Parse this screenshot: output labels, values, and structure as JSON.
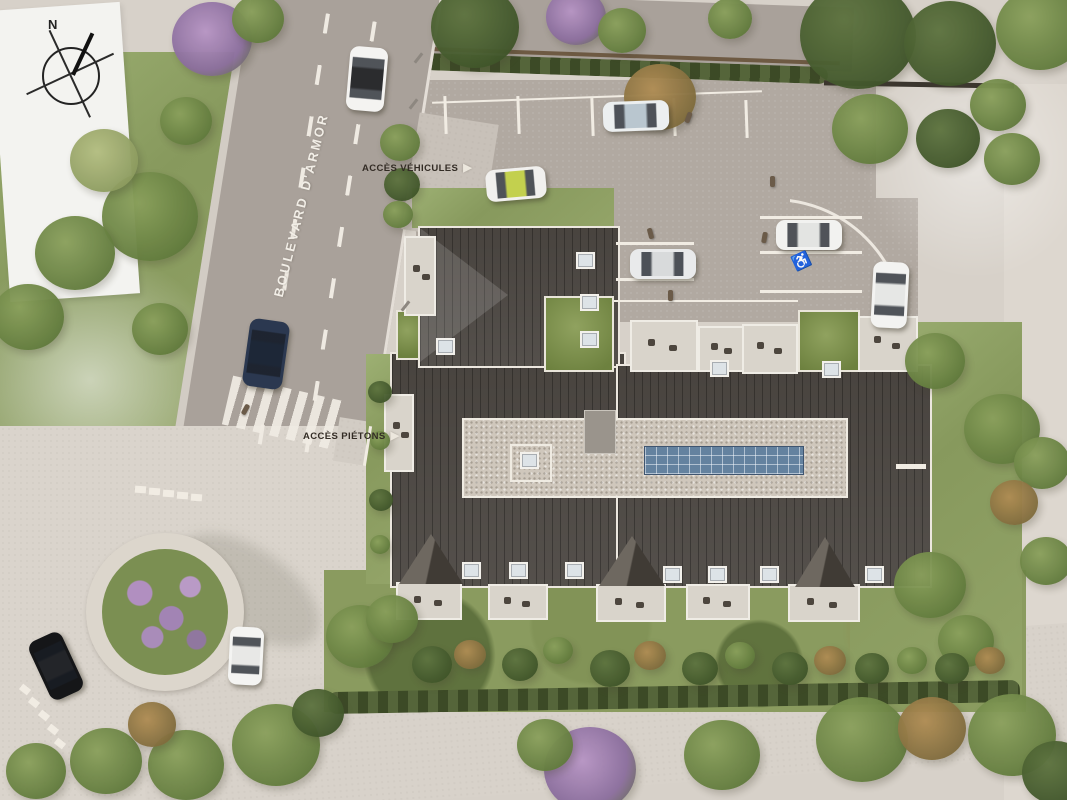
{
  "meta": {
    "title": "Aerial residential site plan rendering"
  },
  "labels": {
    "boulevard": "BOULEVARD D'ARMOR",
    "access_vehicles": "ACCÈS VÉHICULES",
    "access_pedestrians": "ACCÈS PIÉTONS",
    "compass_north": "N",
    "arrow_right": "▶",
    "disabled_parking_symbol": "♿"
  },
  "colors": {
    "ground": "#d7d1c9",
    "road": "#a9a19a",
    "parking": "#b1a9a1",
    "pavement_light": "#dad4cc",
    "roof_dark": "#413c37",
    "gravel": "#cfc7bc",
    "solar_blue": "#64829f",
    "grass": "#8a9b5f",
    "hedge": "#49552e",
    "marking_white": "#f1ece3",
    "white_building": "#f3f3f0",
    "label_dark": "#332c25",
    "label_light": "#f2eee7"
  },
  "scene": {
    "trees": [
      [
        212,
        38,
        40,
        "p"
      ],
      [
        258,
        18,
        26,
        "g"
      ],
      [
        150,
        215,
        48,
        "g"
      ],
      [
        75,
        252,
        40,
        "g"
      ],
      [
        28,
        316,
        36,
        "g"
      ],
      [
        160,
        328,
        28,
        "g"
      ],
      [
        104,
        160,
        34,
        "l"
      ],
      [
        186,
        120,
        26,
        "g"
      ],
      [
        475,
        26,
        44,
        "d"
      ],
      [
        576,
        16,
        30,
        "p"
      ],
      [
        622,
        30,
        24,
        "g"
      ],
      [
        660,
        96,
        36,
        "a"
      ],
      [
        730,
        18,
        22,
        "g"
      ],
      [
        858,
        34,
        58,
        "d"
      ],
      [
        950,
        42,
        46,
        "d"
      ],
      [
        1040,
        28,
        44,
        "g"
      ],
      [
        998,
        104,
        28,
        "g"
      ],
      [
        870,
        128,
        38,
        "g"
      ],
      [
        948,
        138,
        32,
        "d"
      ],
      [
        1012,
        158,
        28,
        "g"
      ],
      [
        400,
        142,
        20,
        "g"
      ],
      [
        402,
        184,
        18,
        "d"
      ],
      [
        398,
        214,
        15,
        "g"
      ],
      [
        380,
        392,
        12,
        "d"
      ],
      [
        380,
        440,
        10,
        "g"
      ],
      [
        381,
        500,
        12,
        "d"
      ],
      [
        380,
        544,
        10,
        "g"
      ],
      [
        935,
        360,
        30,
        "g"
      ],
      [
        1002,
        428,
        38,
        "g"
      ],
      [
        1042,
        462,
        28,
        "g"
      ],
      [
        930,
        584,
        36,
        "g"
      ],
      [
        966,
        640,
        28,
        "g"
      ],
      [
        1014,
        502,
        24,
        "a"
      ],
      [
        1046,
        560,
        26,
        "g"
      ],
      [
        360,
        636,
        34,
        "g"
      ],
      [
        392,
        618,
        26,
        "g"
      ],
      [
        432,
        664,
        20,
        "d"
      ],
      [
        470,
        654,
        16,
        "a"
      ],
      [
        520,
        664,
        18,
        "d"
      ],
      [
        558,
        650,
        15,
        "g"
      ],
      [
        610,
        668,
        20,
        "d"
      ],
      [
        650,
        655,
        16,
        "a"
      ],
      [
        700,
        668,
        18,
        "d"
      ],
      [
        740,
        655,
        15,
        "g"
      ],
      [
        790,
        668,
        18,
        "d"
      ],
      [
        830,
        660,
        16,
        "a"
      ],
      [
        872,
        668,
        17,
        "d"
      ],
      [
        912,
        660,
        15,
        "g"
      ],
      [
        952,
        668,
        17,
        "d"
      ],
      [
        990,
        660,
        15,
        "a"
      ],
      [
        590,
        768,
        46,
        "p"
      ],
      [
        545,
        744,
        28,
        "g"
      ],
      [
        722,
        754,
        38,
        "g"
      ],
      [
        862,
        738,
        46,
        "g"
      ],
      [
        932,
        728,
        34,
        "a"
      ],
      [
        1012,
        734,
        44,
        "g"
      ],
      [
        1056,
        772,
        34,
        "d"
      ],
      [
        276,
        744,
        44,
        "g"
      ],
      [
        186,
        764,
        38,
        "g"
      ],
      [
        106,
        760,
        36,
        "g"
      ],
      [
        36,
        770,
        30,
        "g"
      ],
      [
        152,
        724,
        24,
        "a"
      ],
      [
        318,
        712,
        26,
        "d"
      ]
    ],
    "cars": [
      [
        348,
        47,
        38,
        64,
        5,
        "#f4f3f1",
        "#2b2c2e"
      ],
      [
        486,
        168,
        60,
        32,
        -5,
        "#f1f0ee",
        "#c3d04e"
      ],
      [
        603,
        101,
        66,
        30,
        -2,
        "#eceff0",
        "#b9c6cf"
      ],
      [
        630,
        249,
        66,
        30,
        0,
        "#e9eaeb",
        "#d8dadb"
      ],
      [
        776,
        220,
        66,
        30,
        0,
        "#f2f2f0",
        "#e3e4e2"
      ],
      [
        872,
        262,
        36,
        66,
        3,
        "#f3f3f1",
        "#e6e7e5"
      ],
      [
        246,
        320,
        40,
        68,
        8,
        "#2b3850",
        "#1d2737"
      ],
      [
        38,
        634,
        36,
        64,
        -25,
        "#151618",
        "#232529"
      ],
      [
        229,
        627,
        34,
        58,
        3,
        "#f4f4f2",
        "#e8e8e6"
      ]
    ],
    "people": [
      [
        686,
        112,
        20
      ],
      [
        648,
        228,
        -15
      ],
      [
        762,
        232,
        10
      ],
      [
        668,
        290,
        0
      ],
      [
        243,
        404,
        28
      ],
      [
        770,
        176,
        0
      ]
    ],
    "poles": [
      [
        417,
        52
      ],
      [
        412,
        98
      ],
      [
        404,
        300
      ]
    ],
    "markings": [
      [
        432,
        96,
        330,
        2,
        -2
      ],
      [
        444,
        96,
        3,
        38,
        -2
      ],
      [
        517,
        96,
        3,
        38,
        -2
      ],
      [
        591,
        98,
        3,
        38,
        -2
      ],
      [
        673,
        98,
        3,
        38,
        -2
      ],
      [
        745,
        100,
        3,
        38,
        -2
      ],
      [
        616,
        242,
        78,
        3,
        0
      ],
      [
        616,
        278,
        78,
        3,
        0
      ],
      [
        760,
        216,
        102,
        3,
        0
      ],
      [
        760,
        251,
        102,
        3,
        0
      ],
      [
        760,
        290,
        102,
        3,
        0
      ],
      [
        614,
        300,
        184,
        2,
        0
      ],
      [
        20,
        686,
        10,
        7,
        38
      ],
      [
        29,
        699,
        10,
        7,
        38
      ],
      [
        39,
        712,
        10,
        7,
        38
      ],
      [
        48,
        726,
        10,
        7,
        38
      ],
      [
        55,
        740,
        10,
        7,
        38
      ],
      [
        135,
        486,
        11,
        7,
        4
      ],
      [
        149,
        488,
        11,
        7,
        4
      ],
      [
        163,
        490,
        11,
        7,
        4
      ],
      [
        177,
        492,
        11,
        7,
        4
      ],
      [
        191,
        494,
        11,
        7,
        4
      ],
      [
        896,
        464,
        30,
        5,
        0
      ],
      [
        366,
        426,
        3,
        40,
        9
      ]
    ],
    "skylights": [
      [
        576,
        252
      ],
      [
        580,
        294
      ],
      [
        580,
        331
      ],
      [
        436,
        338
      ],
      [
        710,
        360
      ],
      [
        822,
        361
      ],
      [
        520,
        452
      ],
      [
        462,
        562
      ],
      [
        509,
        562
      ],
      [
        565,
        562
      ],
      [
        663,
        566
      ],
      [
        708,
        566
      ],
      [
        760,
        566
      ],
      [
        865,
        566
      ]
    ],
    "dormers": [
      [
        399,
        534,
        64,
        50
      ],
      [
        599,
        536,
        66,
        50
      ],
      [
        795,
        537,
        60,
        50
      ]
    ],
    "terraces": [
      [
        404,
        236,
        28,
        76
      ],
      [
        384,
        394,
        26,
        74
      ],
      [
        630,
        320,
        64,
        48
      ],
      [
        698,
        326,
        42,
        42
      ],
      [
        742,
        324,
        52,
        46
      ],
      [
        858,
        316,
        56,
        52
      ],
      [
        396,
        582,
        62,
        34
      ],
      [
        488,
        584,
        56,
        32
      ],
      [
        596,
        584,
        66,
        34
      ],
      [
        686,
        584,
        60,
        32
      ],
      [
        788,
        584,
        68,
        34
      ]
    ],
    "green_patches": [
      [
        544,
        296,
        66,
        72
      ],
      [
        798,
        310,
        58,
        58
      ],
      [
        396,
        310,
        20,
        46
      ]
    ]
  }
}
